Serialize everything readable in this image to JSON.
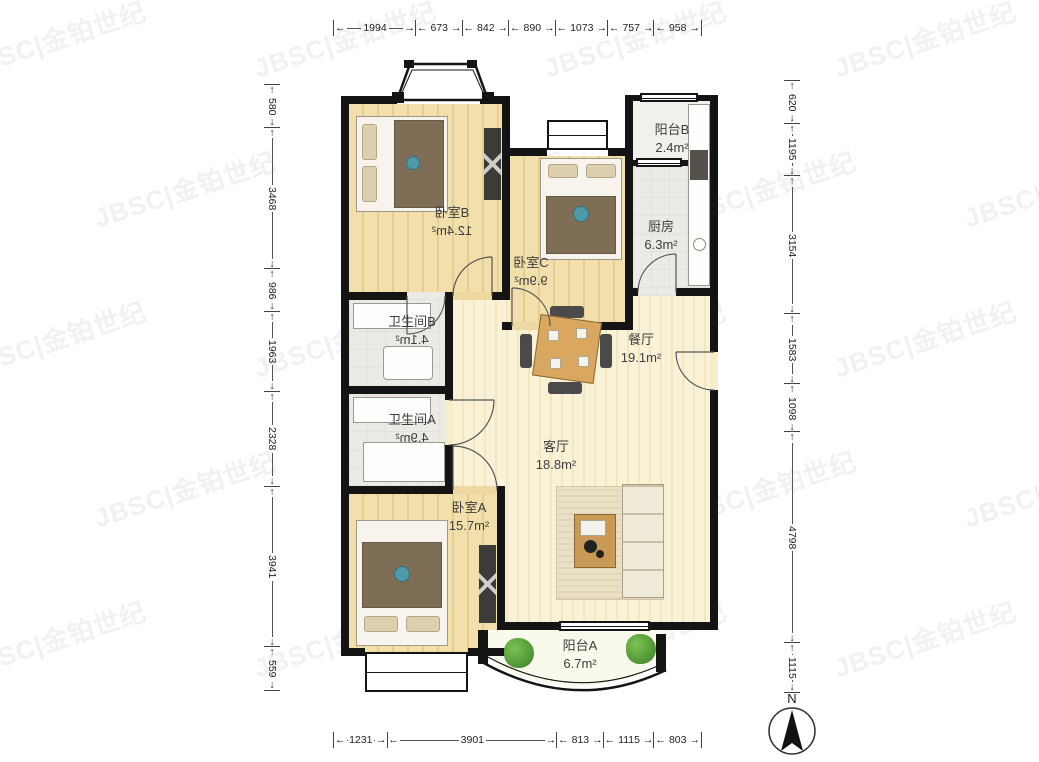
{
  "watermark": {
    "text": "JBSC|金铂世纪"
  },
  "compass": {
    "label": "N"
  },
  "rulers": {
    "top": {
      "values": [
        "1994",
        "673",
        "842",
        "890",
        "1073",
        "757",
        "958"
      ]
    },
    "bottom": {
      "values": [
        "1231",
        "3901",
        "813",
        "1115",
        "803"
      ]
    },
    "left": {
      "values": [
        "580",
        "3468",
        "986",
        "1963",
        "2328",
        "3941",
        "559"
      ]
    },
    "right": {
      "values": [
        "620",
        "1195",
        "3154",
        "1583",
        "1098",
        "4798",
        "1115"
      ]
    }
  },
  "rooms": [
    {
      "name": "卧室B",
      "area": "12.4m²",
      "area_mirrored": true
    },
    {
      "name": "卧室C",
      "area": "9.9m²",
      "area_mirrored": true
    },
    {
      "name": "阳台B",
      "area": "2.4m²",
      "area_mirrored": false
    },
    {
      "name": "厨房",
      "area": "6.3m²",
      "area_mirrored": false
    },
    {
      "name": "餐厅",
      "area": "19.1m²",
      "area_mirrored": false
    },
    {
      "name": "卫生间B",
      "area": "4.1m²",
      "area_mirrored": true
    },
    {
      "name": "卫生间A",
      "area": "4.9m²",
      "area_mirrored": true
    },
    {
      "name": "客厅",
      "area": "18.8m²",
      "area_mirrored": false
    },
    {
      "name": "卧室A",
      "area": "15.7m²",
      "area_mirrored": false
    },
    {
      "name": "阳台A",
      "area": "6.7m²",
      "area_mirrored": false
    }
  ],
  "colors": {
    "wall": "#141414",
    "wood_floor": "#eed9a2",
    "living_floor": "#f8edc9",
    "tile_floor": "#ebeae5",
    "accent_teal": "#4e9aa8",
    "plant_green": "#55a33c"
  }
}
